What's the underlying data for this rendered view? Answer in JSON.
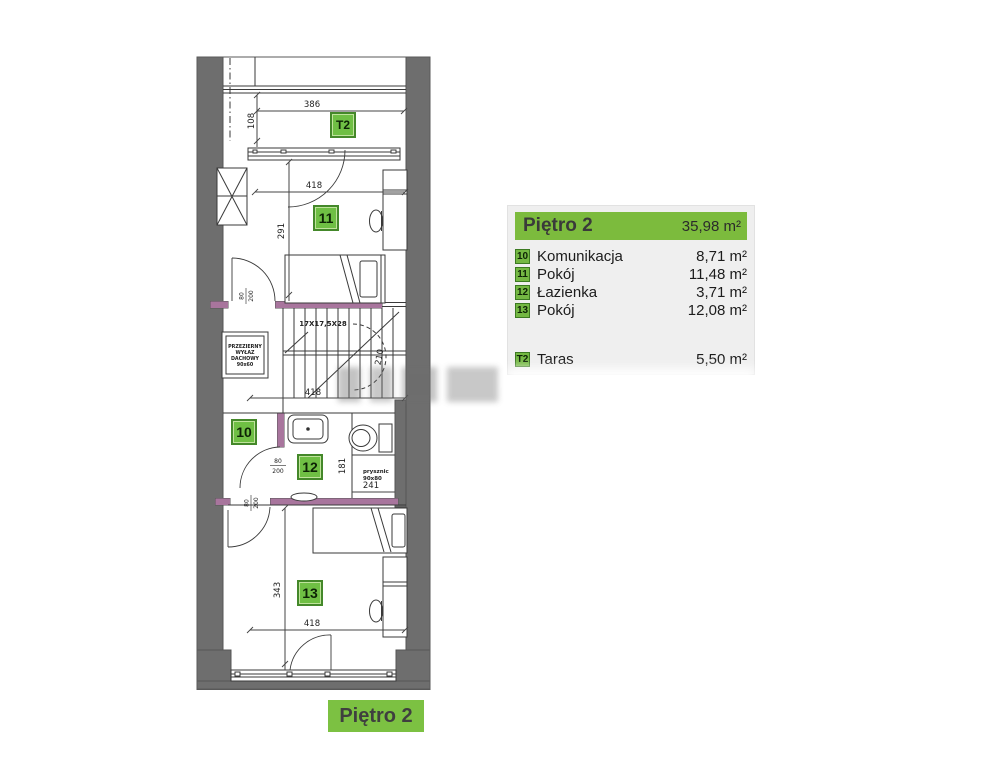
{
  "colors": {
    "green_header": "#7cbb3d",
    "green_badge": "#6fbf44",
    "green_footer": "#7cc142",
    "wall_gray": "#6e6e6e",
    "wall_accent_purple": "#a8759d",
    "legend_bg": "#efefef"
  },
  "legend": {
    "title": "Piętro 2",
    "total_area": "35,98 m²",
    "rows": [
      {
        "badge": "10",
        "name": "Komunikacja",
        "area": "8,71 m²"
      },
      {
        "badge": "11",
        "name": "Pokój",
        "area": "11,48 m²"
      },
      {
        "badge": "12",
        "name": "Łazienka",
        "area": "3,71 m²"
      },
      {
        "badge": "13",
        "name": "Pokój",
        "area": "12,08 m²"
      }
    ],
    "terrace_row": {
      "badge": "T2",
      "name": "Taras",
      "area": "5,50 m²"
    }
  },
  "footer_label": "Piętro 2",
  "plan": {
    "badges": {
      "terrace": "T2",
      "room10": "10",
      "room11": "11",
      "room12": "12",
      "room13": "13"
    },
    "dimensions": {
      "terrace_width": "386",
      "terrace_depth": "108",
      "room11_width": "418",
      "room11_depth": "291",
      "stairs_spec": "17X17,5X28",
      "stairs_clearance": "210",
      "hall_width": "418",
      "bath_depth": "181",
      "bath_width": "241",
      "room13_depth": "343",
      "room13_width": "418",
      "door_width": "80",
      "door_height": "200"
    },
    "skylight": {
      "line1": "PRZEZIERNY",
      "line2": "WYŁAZ",
      "line3": "DACHOWY",
      "line4": "90x60"
    },
    "shower": {
      "line1": "prysznic",
      "line2": "90x80"
    }
  }
}
